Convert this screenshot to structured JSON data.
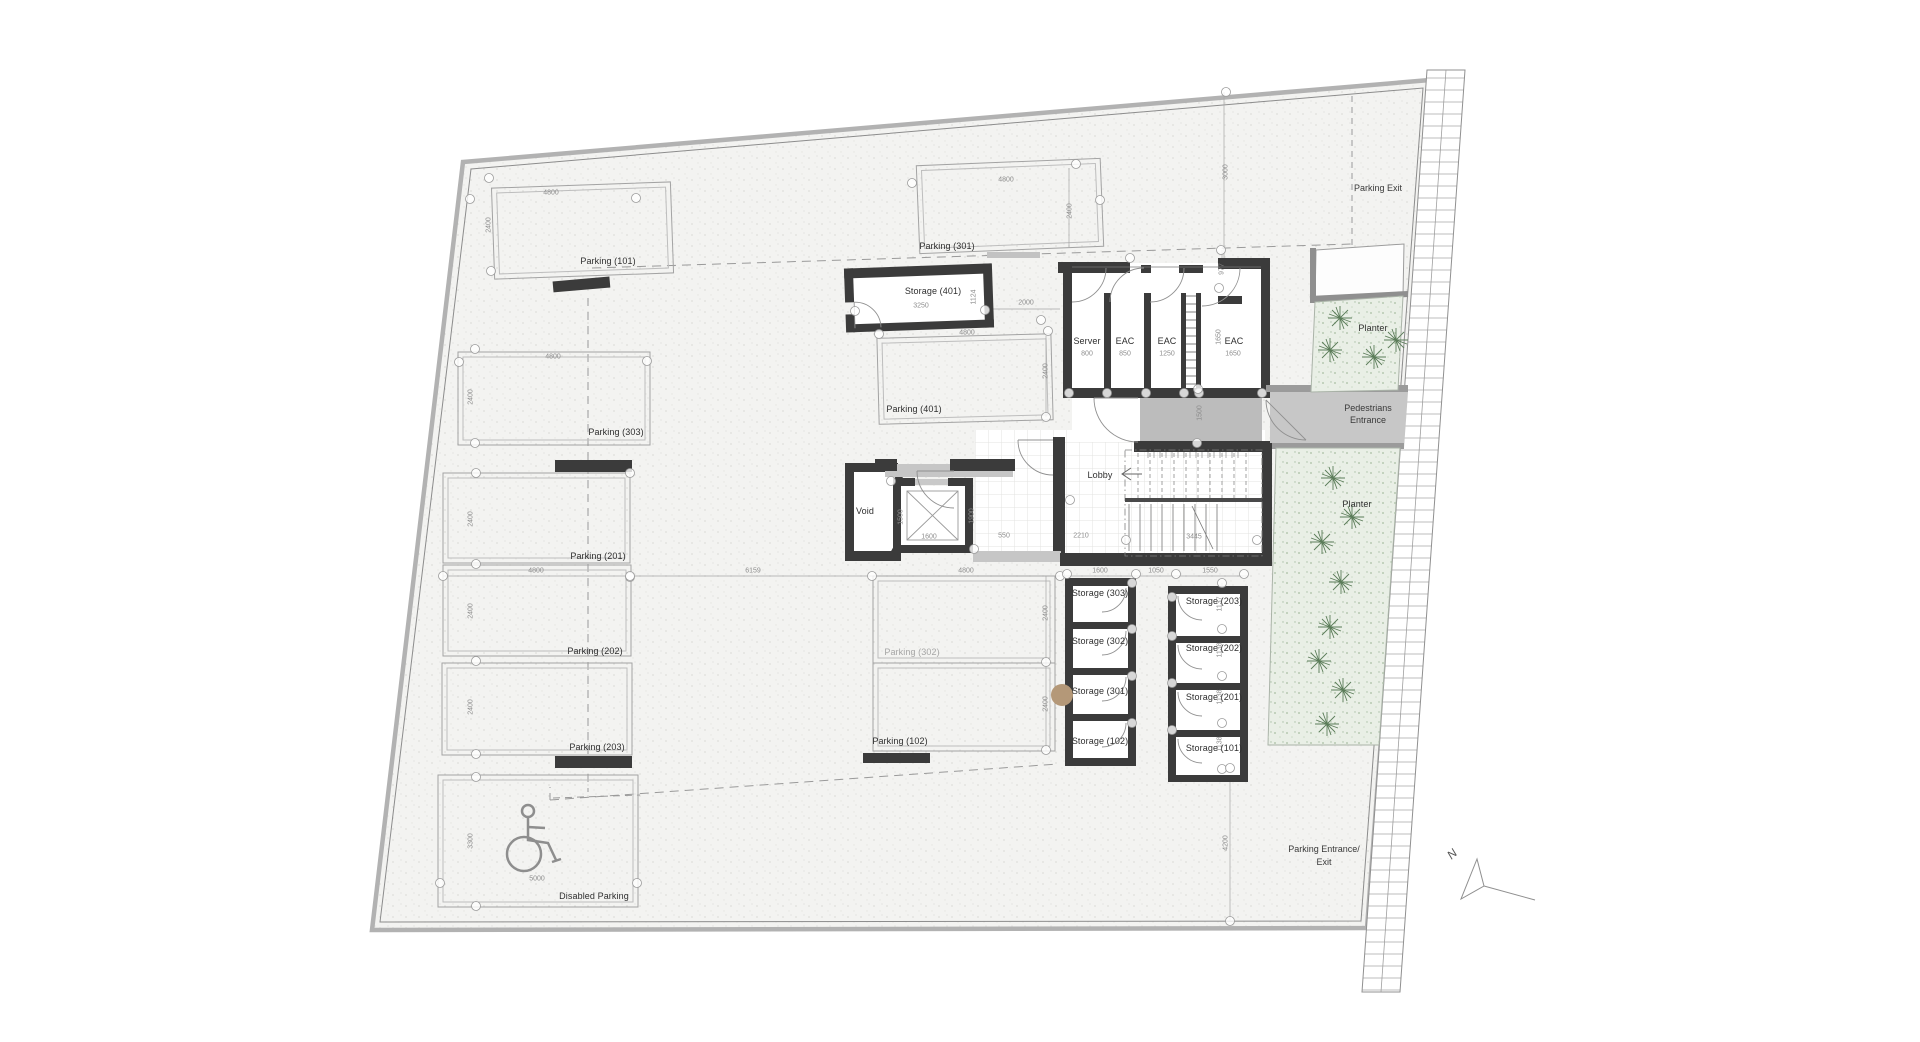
{
  "plan": {
    "north_label": "N",
    "area_labels": {
      "parking_exit": "Parking Exit",
      "pedestrians_entrance_line1": "Pedestrians",
      "pedestrians_entrance_line2": "Entrance",
      "parking_entrance_line1": "Parking Entrance/",
      "parking_entrance_line2": "Exit"
    },
    "colors": {
      "wall": "#3b3b3b",
      "paving": "#f3f3f1",
      "corridor_gray": "#bcbcbc",
      "planter_green": "#e9efe6",
      "boundary_gray": "#b2b2b2",
      "column_tan": "#b49878"
    },
    "rooms": [
      {
        "label": "Parking (101)",
        "x": 608,
        "y": 261
      },
      {
        "label": "Parking (301)",
        "x": 947,
        "y": 246
      },
      {
        "label": "Parking (303)",
        "x": 616,
        "y": 432
      },
      {
        "label": "Parking (201)",
        "x": 598,
        "y": 556
      },
      {
        "label": "Parking (202)",
        "x": 595,
        "y": 651
      },
      {
        "label": "Parking (203)",
        "x": 597,
        "y": 747
      },
      {
        "label": "Disabled Parking",
        "x": 594,
        "y": 896
      },
      {
        "label": "Parking (401)",
        "x": 914,
        "y": 409
      },
      {
        "label": "Parking (302)",
        "x": 912,
        "y": 652,
        "muted": true
      },
      {
        "label": "Parking (102)",
        "x": 900,
        "y": 741
      },
      {
        "label": "Storage (401)",
        "x": 933,
        "y": 291
      },
      {
        "label": "Storage (303)",
        "x": 1100,
        "y": 593
      },
      {
        "label": "Storage (302)",
        "x": 1100,
        "y": 641
      },
      {
        "label": "Storage (301)",
        "x": 1100,
        "y": 691
      },
      {
        "label": "Storage (102)",
        "x": 1100,
        "y": 741
      },
      {
        "label": "Storage (203)",
        "x": 1214,
        "y": 601
      },
      {
        "label": "Storage (202)",
        "x": 1214,
        "y": 648
      },
      {
        "label": "Storage (201)",
        "x": 1214,
        "y": 697
      },
      {
        "label": "Storage (101)",
        "x": 1214,
        "y": 748
      },
      {
        "label": "Server",
        "x": 1087,
        "y": 341
      },
      {
        "label": "EAC",
        "x": 1125,
        "y": 341,
        "key": "eac-850"
      },
      {
        "label": "EAC",
        "x": 1167,
        "y": 341,
        "key": "eac-1250"
      },
      {
        "label": "EAC",
        "x": 1234,
        "y": 341,
        "key": "eac-1650"
      },
      {
        "label": "Lobby",
        "x": 1100,
        "y": 475
      },
      {
        "label": "Void",
        "x": 865,
        "y": 511
      },
      {
        "label": "Planter",
        "x": 1373,
        "y": 328,
        "key": "planter-top"
      },
      {
        "label": "Planter",
        "x": 1357,
        "y": 504,
        "key": "planter-side"
      }
    ],
    "dimensions": [
      {
        "v": "4800",
        "x": 551,
        "y": 193
      },
      {
        "v": "2400",
        "x": 489,
        "y": 225,
        "rot": true
      },
      {
        "v": "4800",
        "x": 1006,
        "y": 180
      },
      {
        "v": "2400",
        "x": 1070,
        "y": 211,
        "rot": true
      },
      {
        "v": "4800",
        "x": 553,
        "y": 357
      },
      {
        "v": "2400",
        "x": 471,
        "y": 397,
        "rot": true
      },
      {
        "v": "2400",
        "x": 471,
        "y": 519,
        "rot": true
      },
      {
        "v": "2400",
        "x": 471,
        "y": 611,
        "rot": true
      },
      {
        "v": "2400",
        "x": 471,
        "y": 707,
        "rot": true
      },
      {
        "v": "3300",
        "x": 471,
        "y": 841,
        "rot": true
      },
      {
        "v": "5000",
        "x": 537,
        "y": 879
      },
      {
        "v": "4800",
        "x": 536,
        "y": 571
      },
      {
        "v": "6159",
        "x": 753,
        "y": 571
      },
      {
        "v": "4800",
        "x": 966,
        "y": 571
      },
      {
        "v": "1600",
        "x": 1100,
        "y": 571
      },
      {
        "v": "1050",
        "x": 1156,
        "y": 571
      },
      {
        "v": "1550",
        "x": 1210,
        "y": 571
      },
      {
        "v": "4800",
        "x": 967,
        "y": 333
      },
      {
        "v": "2400",
        "x": 1046,
        "y": 371,
        "rot": true
      },
      {
        "v": "2400",
        "x": 1046,
        "y": 613,
        "rot": true
      },
      {
        "v": "2400",
        "x": 1046,
        "y": 704,
        "rot": true
      },
      {
        "v": "3250",
        "x": 921,
        "y": 306
      },
      {
        "v": "1124",
        "x": 974,
        "y": 297,
        "rot": true
      },
      {
        "v": "2000",
        "x": 1026,
        "y": 303
      },
      {
        "v": "800",
        "x": 1087,
        "y": 354
      },
      {
        "v": "850",
        "x": 1125,
        "y": 354
      },
      {
        "v": "1250",
        "x": 1167,
        "y": 354
      },
      {
        "v": "1650",
        "x": 1233,
        "y": 354
      },
      {
        "v": "3000",
        "x": 1226,
        "y": 172,
        "rot": true
      },
      {
        "v": "977",
        "x": 1222,
        "y": 269,
        "rot": true
      },
      {
        "v": "1650",
        "x": 1219,
        "y": 337,
        "rot": true
      },
      {
        "v": "1500",
        "x": 1200,
        "y": 413,
        "rot": true
      },
      {
        "v": "1500",
        "x": 901,
        "y": 517,
        "rot": true
      },
      {
        "v": "1600",
        "x": 929,
        "y": 537
      },
      {
        "v": "1900",
        "x": 972,
        "y": 516,
        "rot": true
      },
      {
        "v": "550",
        "x": 1004,
        "y": 536
      },
      {
        "v": "2210",
        "x": 1081,
        "y": 536
      },
      {
        "v": "3445",
        "x": 1194,
        "y": 537
      },
      {
        "v": "1137",
        "x": 1220,
        "y": 604,
        "rot": true
      },
      {
        "v": "1138",
        "x": 1220,
        "y": 650,
        "rot": true
      },
      {
        "v": "1138",
        "x": 1220,
        "y": 697,
        "rot": true
      },
      {
        "v": "1138",
        "x": 1220,
        "y": 744,
        "rot": true
      },
      {
        "v": "4200",
        "x": 1226,
        "y": 843,
        "rot": true
      }
    ]
  }
}
